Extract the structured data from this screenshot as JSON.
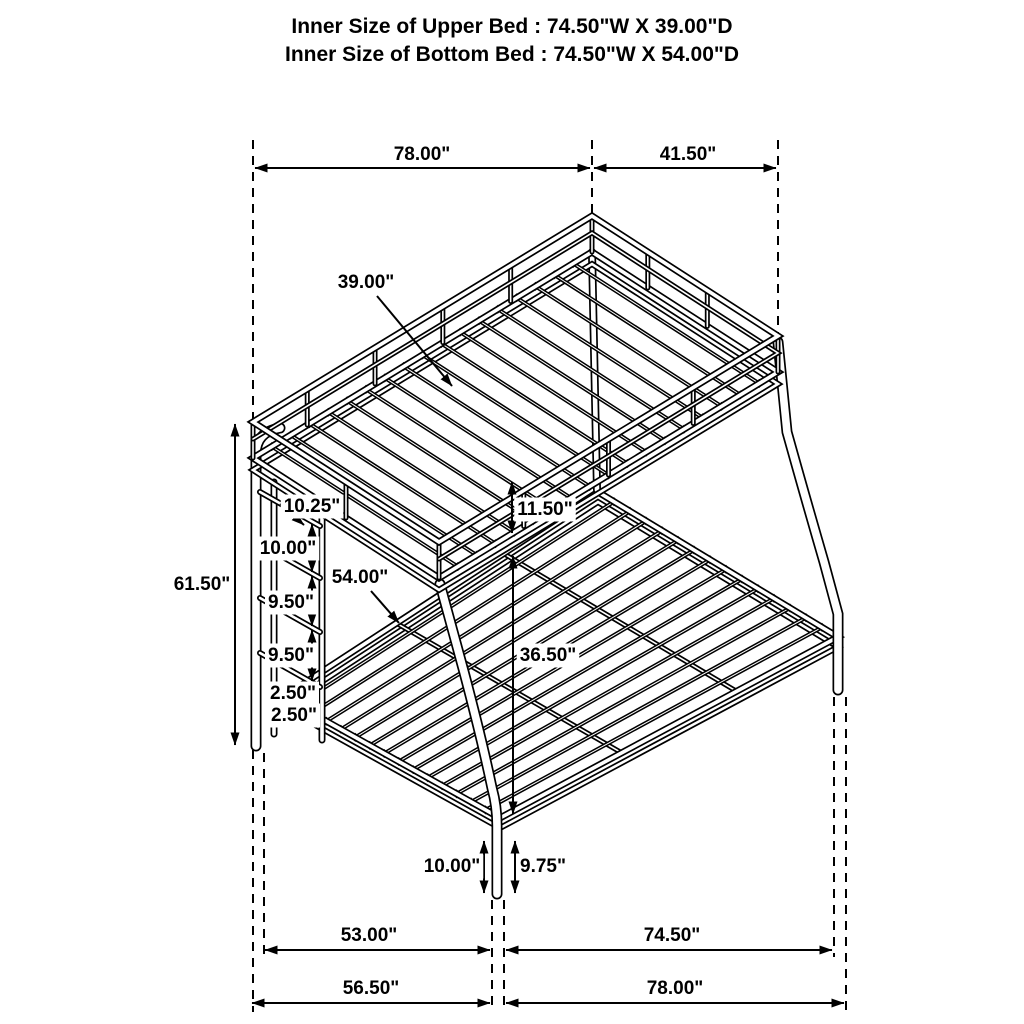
{
  "title": {
    "line1": "Inner Size of Upper Bed : 74.50\"W X 39.00\"D",
    "line2": "Inner Size of Bottom Bed : 74.50\"W X 54.00\"D"
  },
  "diagram": {
    "type": "isometric-line-drawing",
    "subject": "twin-over-full-bunk-bed-dimensions",
    "colors": {
      "line": "#000000",
      "background": "#ffffff",
      "label_bg": "#ffffff"
    },
    "label_font_size": 19,
    "guides": [
      {
        "x": 253,
        "y1": 140,
        "y2": 427
      },
      {
        "x": 253,
        "y1": 750,
        "y2": 1012
      },
      {
        "x": 264,
        "y1": 753,
        "y2": 957
      },
      {
        "x": 592,
        "y1": 140,
        "y2": 215
      },
      {
        "x": 778,
        "y1": 140,
        "y2": 334
      },
      {
        "x": 492,
        "y1": 900,
        "y2": 1012
      },
      {
        "x": 504,
        "y1": 900,
        "y2": 1012
      },
      {
        "x": 834,
        "y1": 697,
        "y2": 957
      },
      {
        "x": 846,
        "y1": 697,
        "y2": 1012
      }
    ],
    "dimensions": [
      {
        "label": "78.00\"",
        "name": "upper-length",
        "lx": 422,
        "ly": 160,
        "type": "h",
        "x1": 255,
        "x2": 590,
        "y": 168
      },
      {
        "label": "41.50\"",
        "name": "upper-depth-overall",
        "lx": 688,
        "ly": 160,
        "type": "h",
        "x1": 594,
        "x2": 776,
        "y": 168
      },
      {
        "label": "39.00\"",
        "name": "upper-inner-depth",
        "lx": 366,
        "ly": 288,
        "type": "leader",
        "x1": 377,
        "y1": 296,
        "x2": 452,
        "y2": 386
      },
      {
        "label": "61.50\"",
        "name": "overall-height",
        "lx": 202,
        "ly": 590,
        "type": "v",
        "x": 235,
        "y1": 424,
        "y2": 745
      },
      {
        "label": "10.25\"",
        "name": "ladder-top-gap",
        "lx": 312,
        "ly": 512,
        "box": 1,
        "type": "diag",
        "x1": 280,
        "y1": 504,
        "x2": 304,
        "y2": 525
      },
      {
        "label": "10.00\"",
        "name": "ladder-gap-1",
        "lx": 288,
        "ly": 554,
        "box": 1,
        "type": "v",
        "x": 312,
        "y1": 524,
        "y2": 572
      },
      {
        "label": "9.50\"",
        "name": "ladder-gap-2",
        "lx": 291,
        "ly": 608,
        "box": 1,
        "type": "v",
        "x": 312,
        "y1": 576,
        "y2": 626
      },
      {
        "label": "9.50\"",
        "name": "ladder-gap-3",
        "lx": 291,
        "ly": 661,
        "box": 1,
        "type": "v",
        "x": 312,
        "y1": 630,
        "y2": 681
      },
      {
        "label": "2.50\"",
        "name": "ladder-gap-4",
        "lx": 293,
        "ly": 699,
        "box": 1,
        "type": "v",
        "x": 312,
        "y1": 685,
        "y2": 704
      },
      {
        "label": "2.50\"",
        "name": "ladder-gap-5",
        "lx": 294,
        "ly": 721,
        "box": 1,
        "type": "v",
        "x": 312,
        "y1": 708,
        "y2": 723
      },
      {
        "label": "54.00\"",
        "name": "lower-inner-depth",
        "lx": 360,
        "ly": 583,
        "box": 1,
        "type": "leader",
        "x1": 371,
        "y1": 591,
        "x2": 399,
        "y2": 623
      },
      {
        "label": "11.50\"",
        "name": "bunk-clearance",
        "lx": 545,
        "ly": 515,
        "box": 1,
        "type": "v",
        "x": 512,
        "y1": 482,
        "y2": 533
      },
      {
        "label": "36.50\"",
        "name": "lower-deck-height",
        "lx": 548,
        "ly": 661,
        "box": 1,
        "type": "v",
        "x": 513,
        "y1": 556,
        "y2": 814
      },
      {
        "label": "10.00\"",
        "name": "front-leg-height",
        "lx": 452,
        "ly": 872,
        "type": "v",
        "x": 484,
        "y1": 841,
        "y2": 893
      },
      {
        "label": "9.75\"",
        "name": "front-leg-inner-height",
        "lx": 543,
        "ly": 872,
        "type": "v",
        "x": 515,
        "y1": 841,
        "y2": 893
      },
      {
        "label": "53.00\"",
        "name": "bottom-span-left-inner",
        "lx": 369,
        "ly": 941,
        "type": "h",
        "x1": 265,
        "x2": 490,
        "y": 950
      },
      {
        "label": "74.50\"",
        "name": "bottom-span-right-inner",
        "lx": 672,
        "ly": 941,
        "type": "h",
        "x1": 506,
        "x2": 832,
        "y": 950
      },
      {
        "label": "56.50\"",
        "name": "bottom-span-left-outer",
        "lx": 371,
        "ly": 994,
        "type": "h",
        "x1": 252,
        "x2": 490,
        "y": 1003
      },
      {
        "label": "78.00\"",
        "name": "bottom-span-right-outer",
        "lx": 675,
        "ly": 994,
        "type": "h",
        "x1": 506,
        "x2": 844,
        "y": 1003
      }
    ]
  }
}
